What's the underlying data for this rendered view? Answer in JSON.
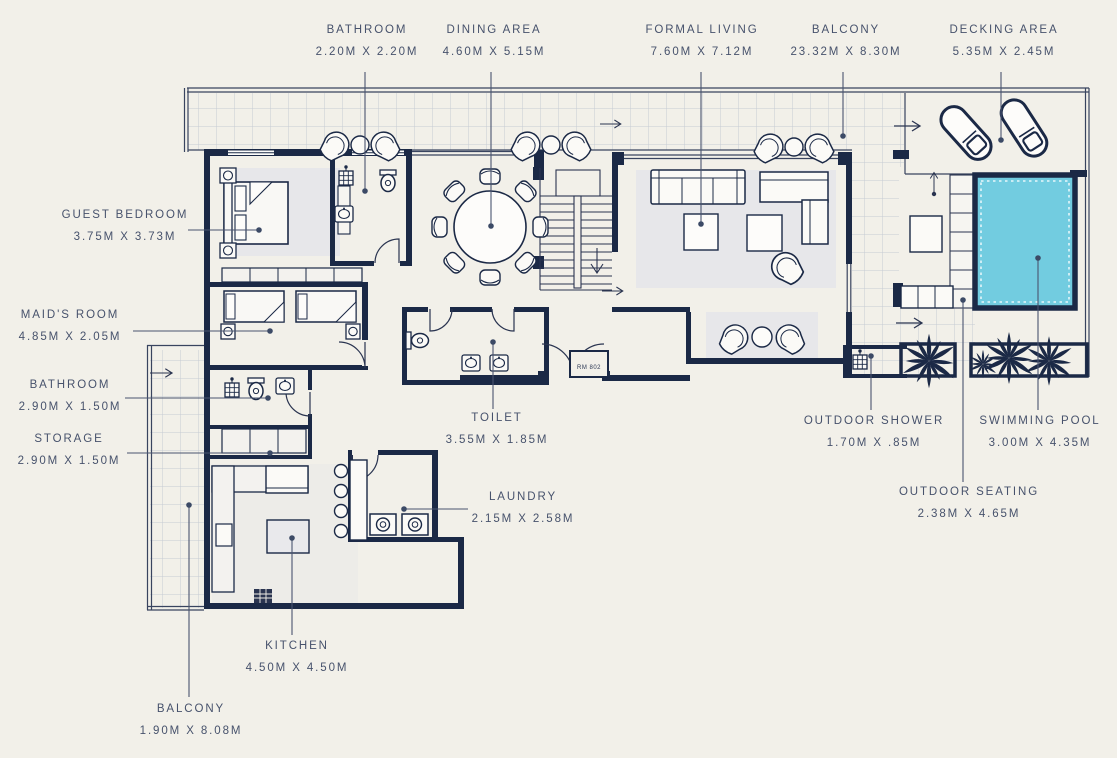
{
  "room_number": "RM 802",
  "colors": {
    "background": "#f2f0e9",
    "wall": "#1b2946",
    "text": "#47526c",
    "pool": "#72cce0",
    "rug": "#e7e7ea",
    "tile_line": "#c6cbd4"
  },
  "labels": {
    "bathroom_top": {
      "name": "BATHROOM",
      "dims": "2.20M X 2.20M"
    },
    "dining_area": {
      "name": "DINING AREA",
      "dims": "4.60M X 5.15M"
    },
    "formal_living": {
      "name": "FORMAL LIVING",
      "dims": "7.60M X 7.12M"
    },
    "balcony_top": {
      "name": "BALCONY",
      "dims": "23.32M X 8.30M"
    },
    "decking_area": {
      "name": "DECKING AREA",
      "dims": "5.35M X 2.45M"
    },
    "guest_bedroom": {
      "name": "GUEST BEDROOM",
      "dims": "3.75M X 3.73M"
    },
    "maids_room": {
      "name": "MAID'S ROOM",
      "dims": "4.85M X 2.05M"
    },
    "bathroom_left": {
      "name": "BATHROOM",
      "dims": "2.90M X 1.50M"
    },
    "storage": {
      "name": "STORAGE",
      "dims": "2.90M X 1.50M"
    },
    "toilet": {
      "name": "TOILET",
      "dims": "3.55M X 1.85M"
    },
    "laundry": {
      "name": "LAUNDRY",
      "dims": "2.15M X 2.58M"
    },
    "kitchen": {
      "name": "KITCHEN",
      "dims": "4.50M X 4.50M"
    },
    "balcony_bottom": {
      "name": "BALCONY",
      "dims": "1.90M X 8.08M"
    },
    "outdoor_shower": {
      "name": "OUTDOOR SHOWER",
      "dims": "1.70M X .85M"
    },
    "swimming_pool": {
      "name": "SWIMMING POOL",
      "dims": "3.00M X 4.35M"
    },
    "outdoor_seating": {
      "name": "OUTDOOR SEATING",
      "dims": "2.38M X 4.65M"
    }
  }
}
